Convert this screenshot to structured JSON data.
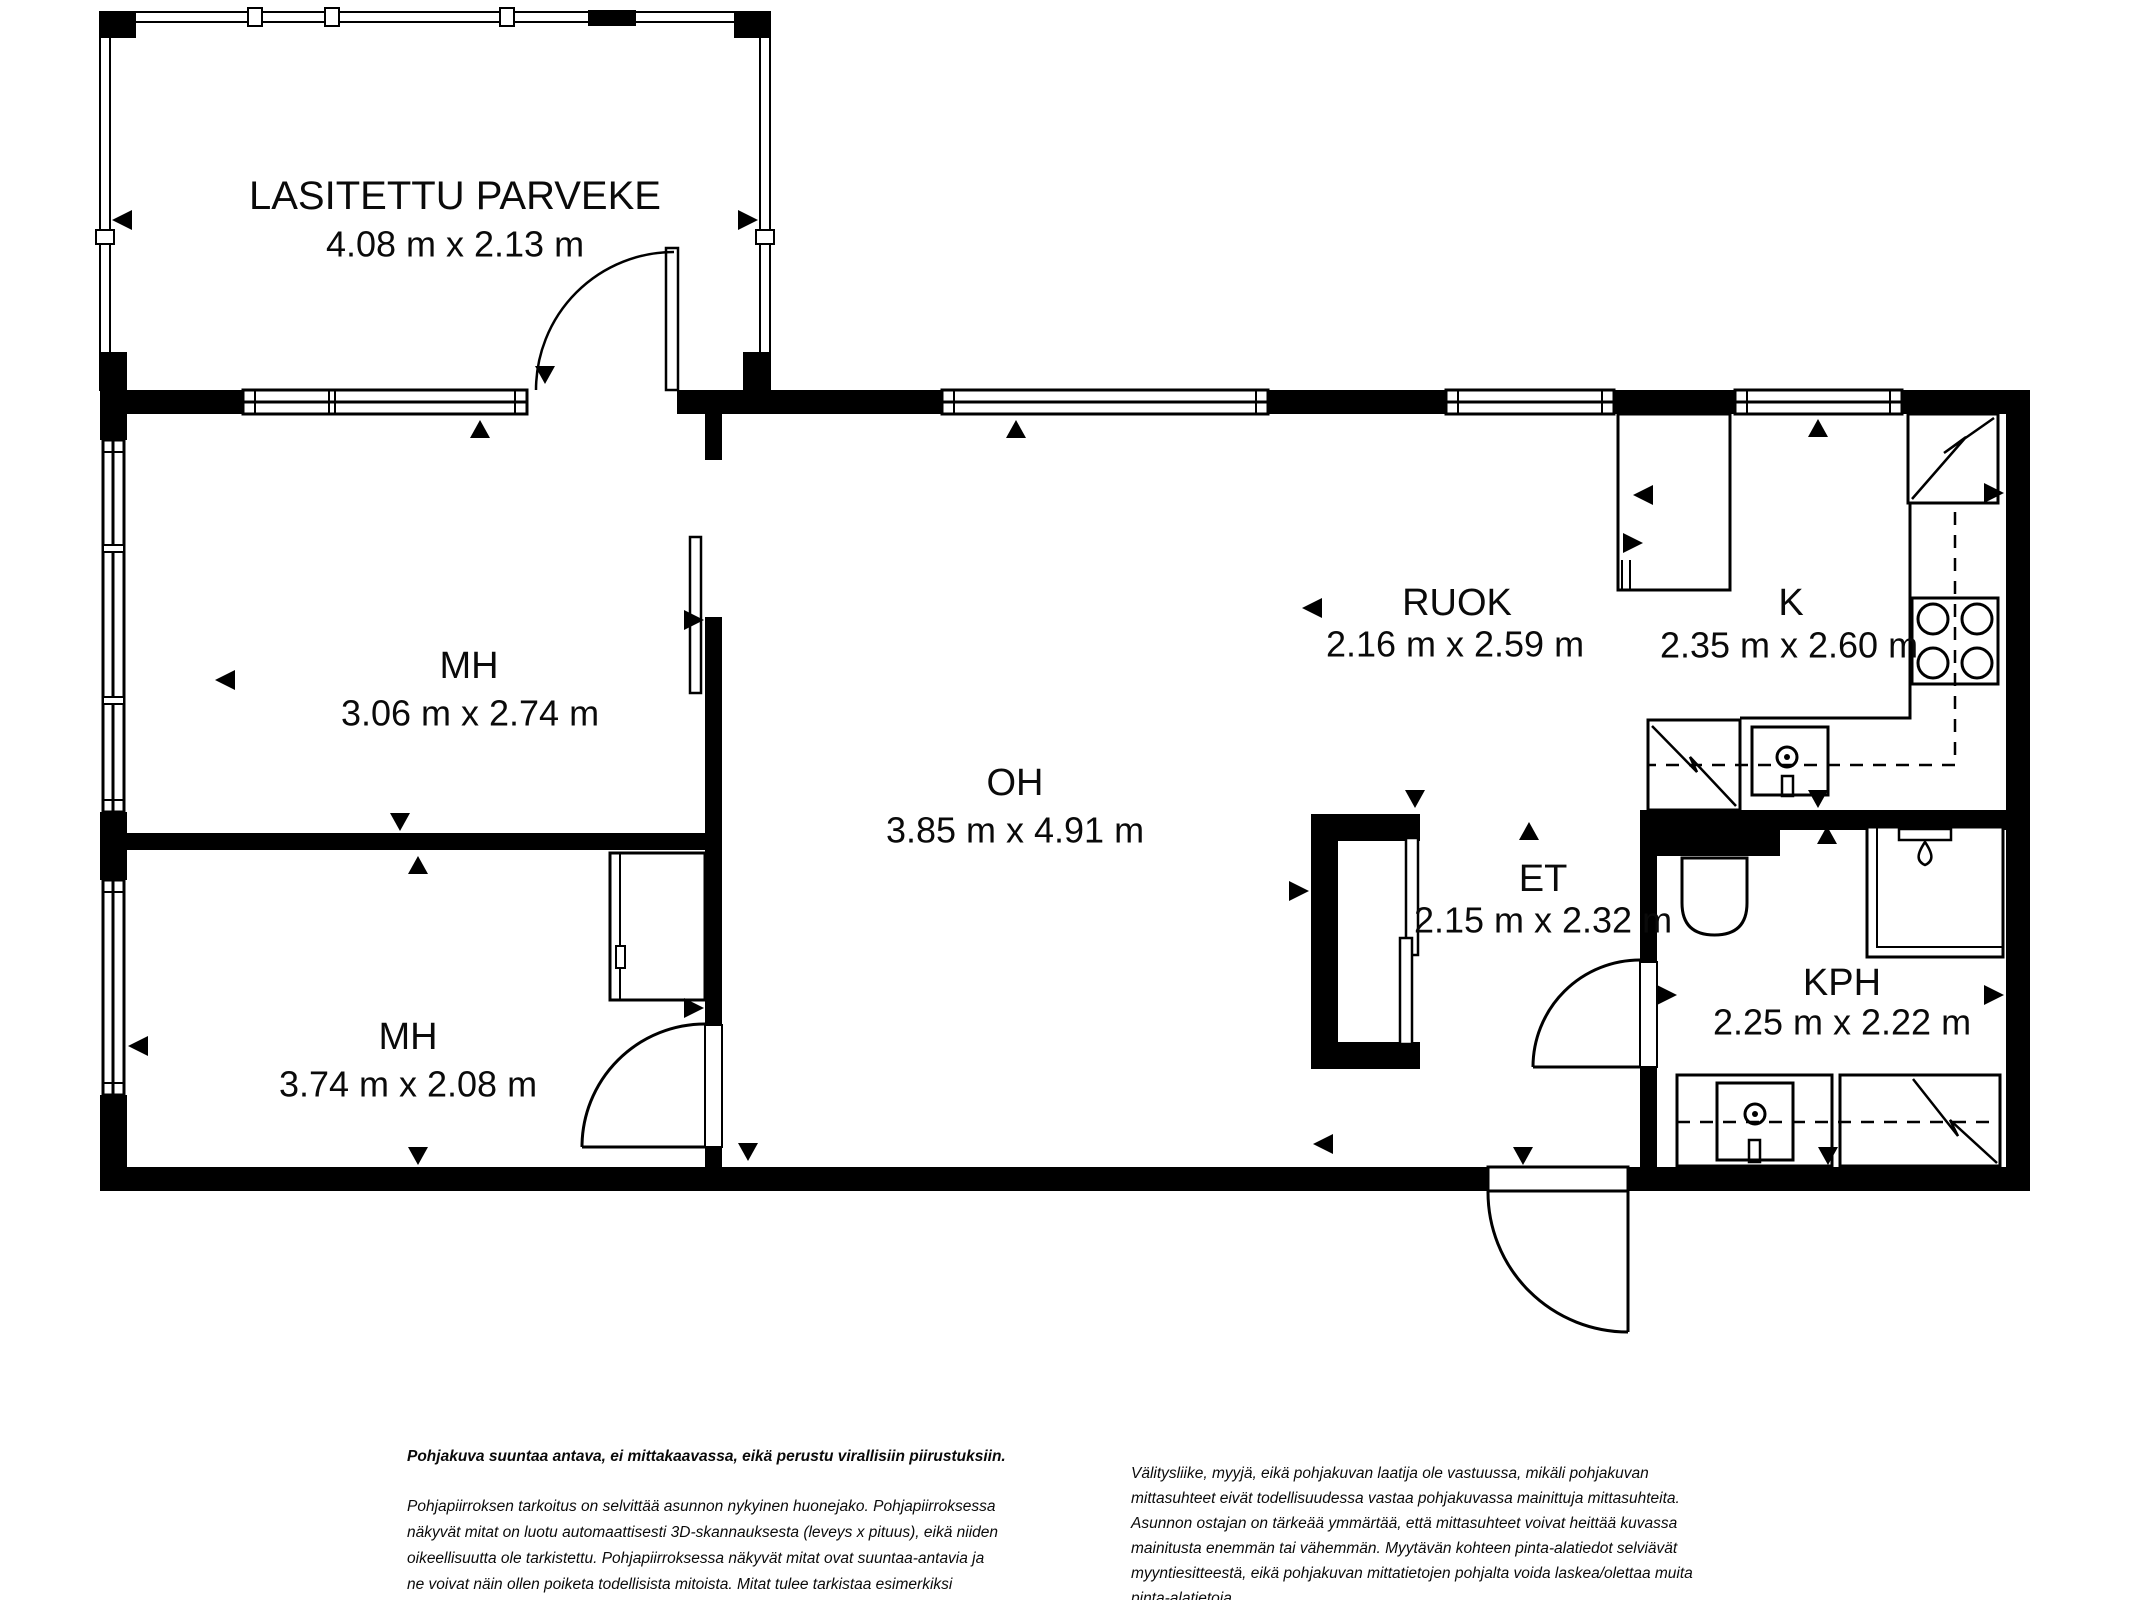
{
  "floorplan": {
    "balcony": {
      "name": "LASITETTU PARVEKE",
      "dims": "4.08 m x 2.13 m"
    },
    "rooms": [
      {
        "key": "mh1",
        "name": "MH",
        "dims": "3.06 m x 2.74 m"
      },
      {
        "key": "mh2",
        "name": "MH",
        "dims": "3.74 m x 2.08 m"
      },
      {
        "key": "oh",
        "name": "OH",
        "dims": "3.85 m x 4.91 m"
      },
      {
        "key": "ruok",
        "name": "RUOK",
        "dims": "2.16 m x 2.59 m"
      },
      {
        "key": "k",
        "name": "K",
        "dims": "2.35 m x 2.60 m"
      },
      {
        "key": "et",
        "name": "ET",
        "dims": "2.15 m x 2.32 m"
      },
      {
        "key": "kph",
        "name": "KPH",
        "dims": "2.25 m x 2.22 m"
      }
    ]
  },
  "footer": {
    "disclaimer_bold": "Pohjakuva suuntaa antava, ei mittakaavassa, eikä perustu virallisiin piirustuksiin.",
    "left_paragraph": "Pohjapiirroksen tarkoitus on selvittää asunnon nykyinen huonejako. Pohjapiirroksessa\nnäkyvät mitat on luotu automaattisesti 3D-skannauksesta (leveys x pituus), eikä niiden\noikeellisuutta ole tarkistettu. Pohjapiirroksessa näkyvät mitat ovat suuntaa-antavia ja\nne voivat näin ollen poiketa todellisista mitoista. Mitat tulee tarkistaa esimerkiksi\nremonttia suunniteltaessa. Mittauskohdat on merkitty kuvaan pienillä kolmioilla.",
    "right_paragraph": "Välitysliike, myyjä, eikä pohjakuvan laatija ole vastuussa, mikäli pohjakuvan\nmittasuhteet eivät todellisuudessa vastaa pohjakuvassa mainittuja mittasuhteita.\nAsunnon ostajan on tärkeää ymmärtää, että mittasuhteet voivat heittää kuvassa\nmainitusta enemmän tai vähemmän. Myytävän kohteen pinta-alatiedot selviävät\nmyyntiesitteestä, eikä pohjakuvan mittatietojen pohjalta voida laskea/olettaa muita\npinta-alatietoja."
  },
  "colors": {
    "line": "#000000",
    "text": "#0a0a0a",
    "background": "#ffffff"
  }
}
